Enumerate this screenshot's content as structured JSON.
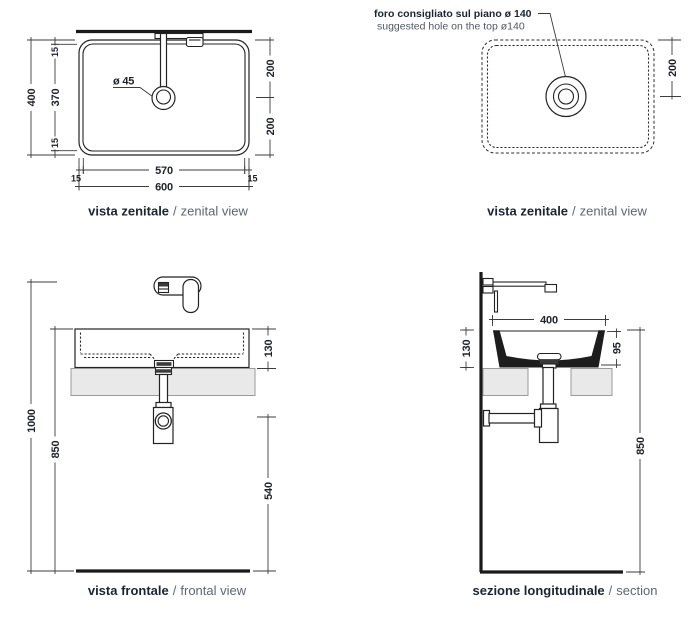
{
  "colors": {
    "line": "#232323",
    "dim_line": "#3c3c3c",
    "counter_fill": "#e9e9e9",
    "counter_stroke": "#9a9a9a",
    "caption_bold": "#1b2531",
    "caption_gray": "#5d6670",
    "note_gray": "#53595f",
    "dim_text": "#20242c"
  },
  "views": {
    "zenital_left": {
      "caption": {
        "bold": "vista zenitale",
        "sep": "/",
        "regular": "zenital view"
      },
      "dims": {
        "overall_height": "400",
        "rim_top": "15",
        "inner_height": "370",
        "rim_bottom": "15",
        "right_upper": "200",
        "right_lower": "200",
        "inner_width": "570",
        "offset_left": "15",
        "offset_right": "15",
        "overall_width": "600",
        "drain_diameter": "ø 45"
      }
    },
    "zenital_right": {
      "caption": {
        "bold": "vista zenitale",
        "sep": "/",
        "regular": "zenital view"
      },
      "note": {
        "line1": "foro consigliato sul piano ø 140",
        "line2": "suggested hole on the top ø140"
      },
      "dims": {
        "hole_center_offset": "200"
      }
    },
    "frontal": {
      "caption": {
        "bold": "vista frontale",
        "sep": "/",
        "regular": "frontal view"
      },
      "dims": {
        "faucet_height": "1000",
        "rim_height": "850",
        "basin_height": "130",
        "drain_height": "540"
      }
    },
    "section": {
      "caption": {
        "bold": "sezione longitudinale",
        "sep": "/",
        "regular": "section"
      },
      "dims": {
        "basin_width": "400",
        "inner_depth": "95",
        "basin_height": "130",
        "rim_height": "850"
      }
    }
  }
}
